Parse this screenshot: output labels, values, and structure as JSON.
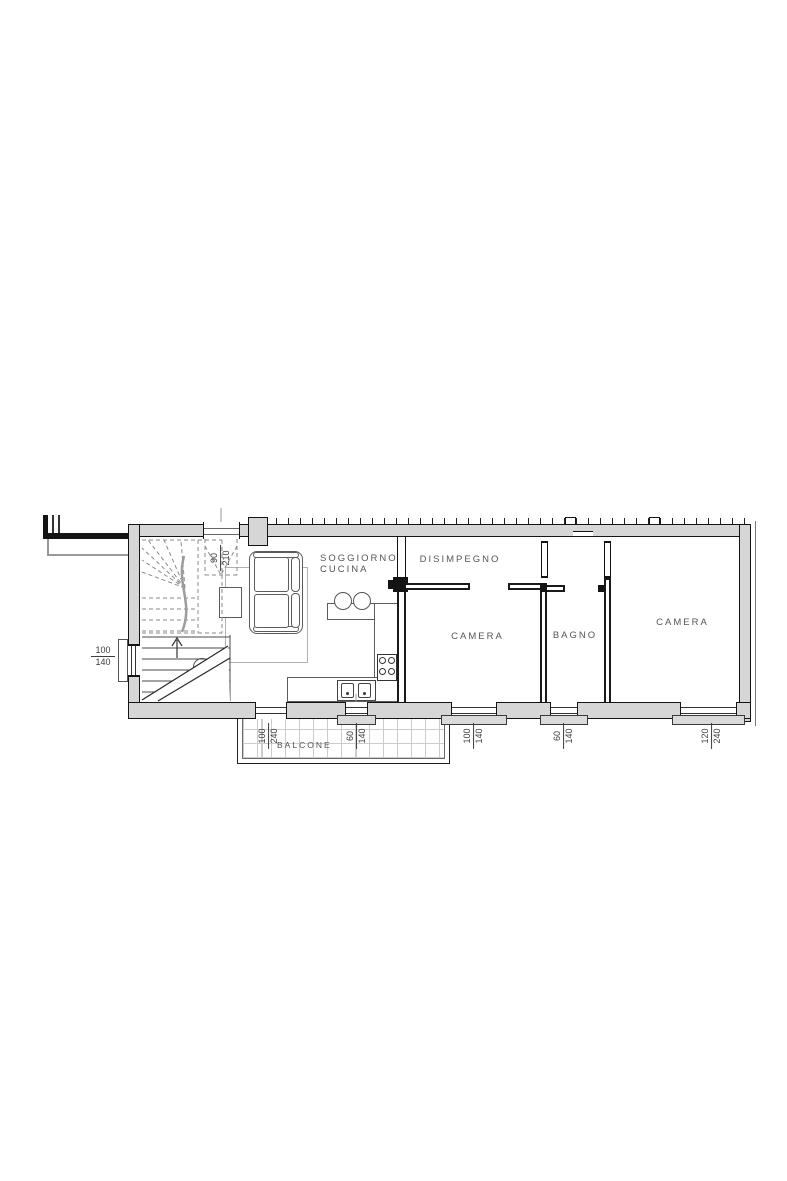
{
  "labels": {
    "soggiorno_line1": "SOGGIORNO",
    "soggiorno_line2": "CUCINA",
    "disimpegno": "DISIMPEGNO",
    "camera_1": "CAMERA",
    "bagno": "BAGNO",
    "camera_2": "CAMERA",
    "balcone": "BALCONE"
  },
  "dimensions": {
    "entrance_door": {
      "width_cm": "90",
      "height_cm": "210"
    },
    "stair_window": {
      "width_cm": "100",
      "height_cm": "140"
    },
    "balcony_door": {
      "width_cm": "100",
      "height_cm": "240"
    },
    "kitchen_window": {
      "width_cm": "60",
      "height_cm": "140"
    },
    "camera1_window": {
      "width_cm": "100",
      "height_cm": "140"
    },
    "bagno_window": {
      "width_cm": "60",
      "height_cm": "140"
    },
    "camera2_window": {
      "width_cm": "120",
      "height_cm": "240"
    }
  },
  "symbols": {
    "light_point": "L"
  },
  "colors": {
    "wall_fill": "#d6d6d6",
    "wall_line": "#141414",
    "annotation_text": "#565656"
  }
}
